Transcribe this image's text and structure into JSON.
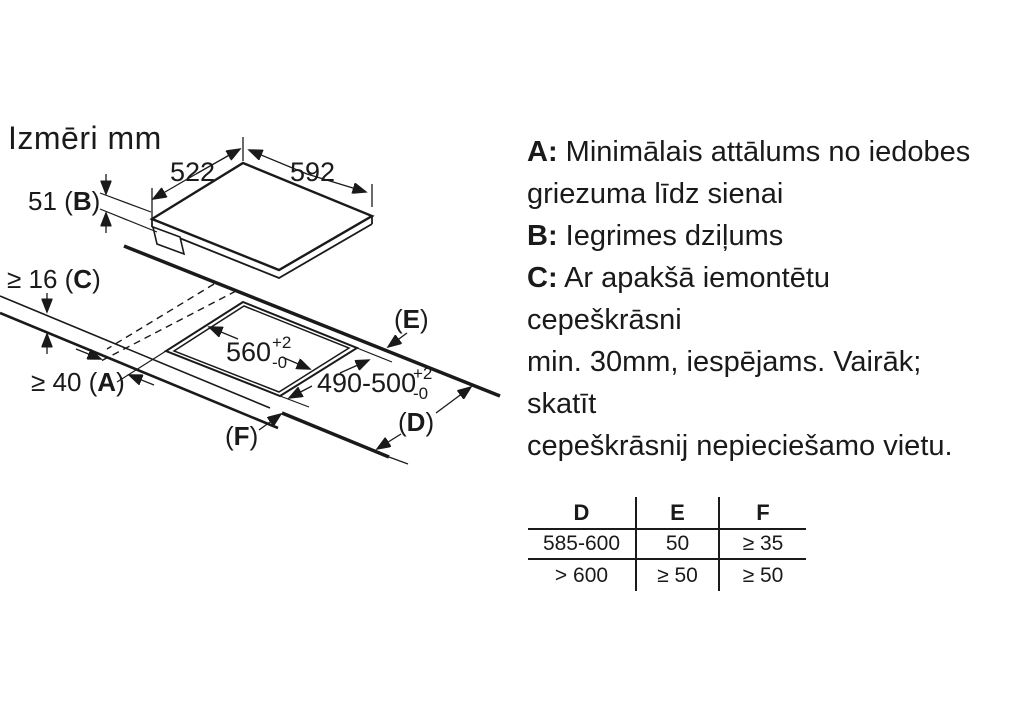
{
  "colors": {
    "ink": "#1a1a1a",
    "bg": "#ffffff"
  },
  "title": "Izmēri mm",
  "diagram": {
    "dim_left_edge": "522",
    "dim_right_edge": "592",
    "sink_depth": {
      "pre": "51 (",
      "key": "B",
      "post": ")"
    },
    "worktop_thickness": {
      "pre": "≥ 16 (",
      "key": "C",
      "post": ")"
    },
    "wall_distance": {
      "pre": "≥ 40 (",
      "key": "A",
      "post": ")"
    },
    "cutout_width": {
      "value": "560",
      "sup": "+2",
      "sub": "-0"
    },
    "cutout_depth": {
      "value": "490-500",
      "sup": "+2",
      "sub": "-0"
    },
    "label_e": {
      "pre": "(",
      "key": "E",
      "post": ")"
    },
    "label_d": {
      "pre": "(",
      "key": "D",
      "post": ")"
    },
    "label_f": {
      "pre": "(",
      "key": "F",
      "post": ")"
    }
  },
  "notes": {
    "lines": [
      {
        "bold": "A:",
        "text": " Minimālais attālums no iedobes"
      },
      {
        "bold": "",
        "text": "griezuma līdz sienai"
      },
      {
        "bold": "B:",
        "text": " Iegrimes dziļums"
      },
      {
        "bold": "C:",
        "text": " Ar apakšā iemontētu"
      },
      {
        "bold": "",
        "text": "cepeškrāsni"
      },
      {
        "bold": "",
        "text": "min. 30mm, iespējams. Vairāk;"
      },
      {
        "bold": "",
        "text": "skatīt"
      },
      {
        "bold": "",
        "text": "cepeškrāsnij nepieciešamo vietu."
      }
    ]
  },
  "table": {
    "headers": [
      "D",
      "E",
      "F"
    ],
    "rows": [
      [
        "585-600",
        "50",
        "≥ 35"
      ],
      [
        "> 600",
        "≥ 50",
        "≥ 50"
      ]
    ]
  }
}
